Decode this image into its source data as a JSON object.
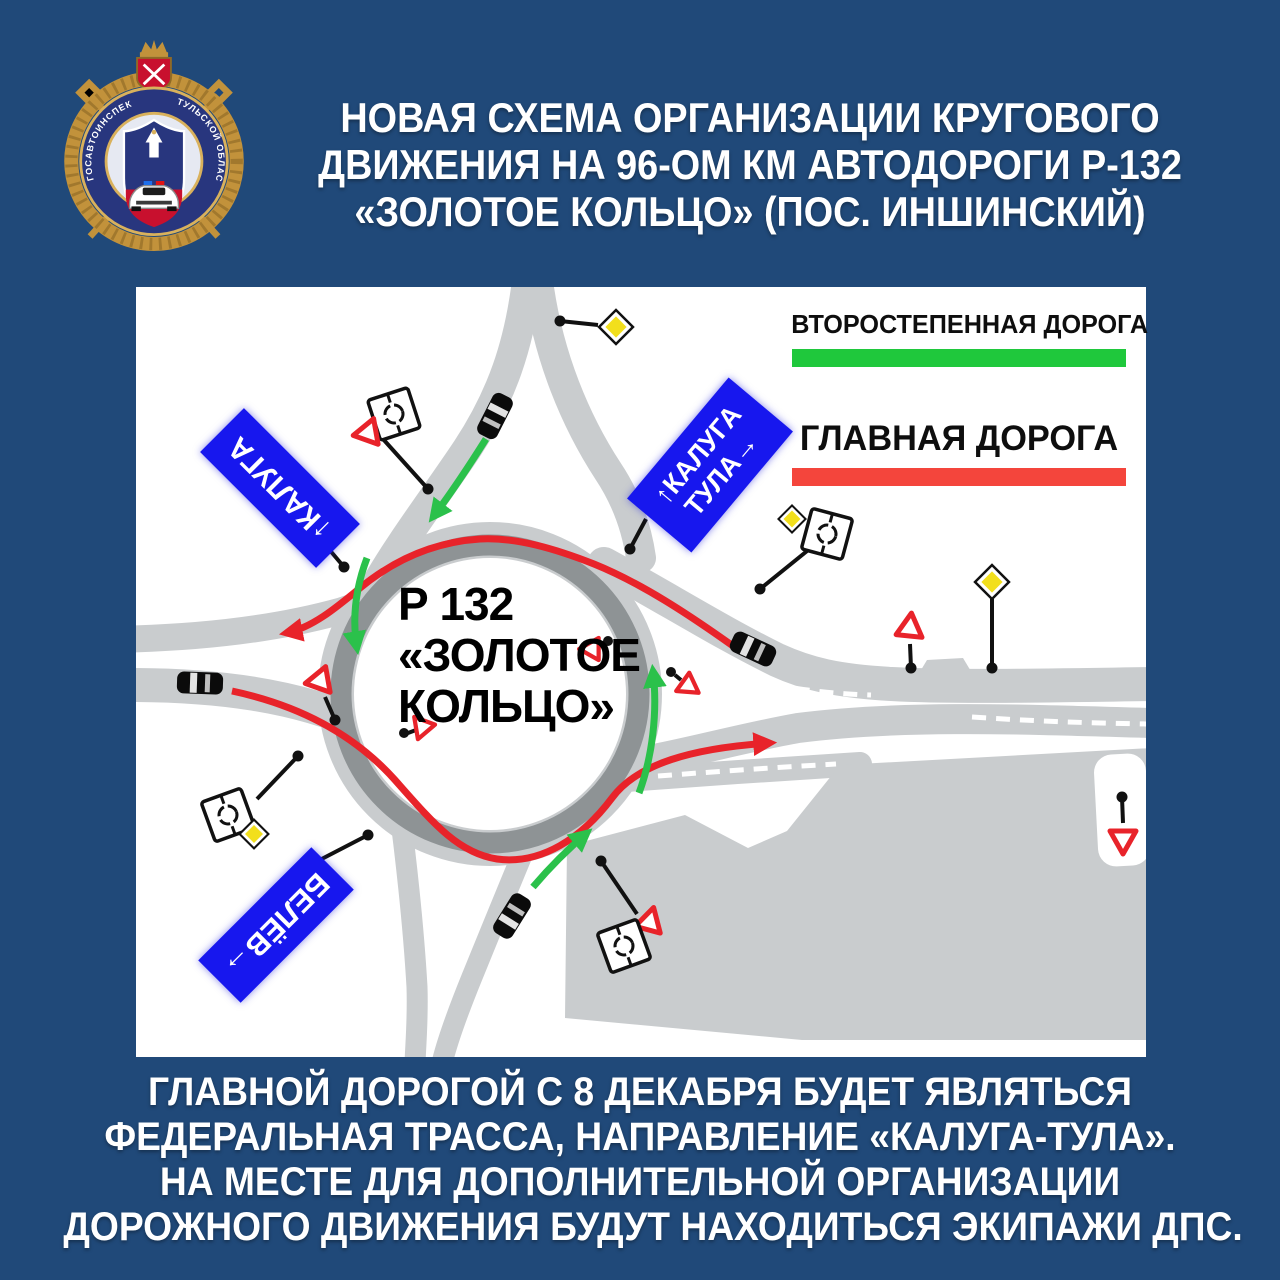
{
  "header": {
    "title_lines": [
      "НОВАЯ СХЕМА ОРГАНИЗАЦИИ КРУГОВОГО",
      "ДВИЖЕНИЯ НА 96-ОМ КМ АВТОДОРОГИ Р-132",
      "«ЗОЛОТОЕ КОЛЬЦО» (ПОС. ИНШИНСКИЙ)"
    ]
  },
  "emblem": {
    "ring_text_left": "ГОСАВТОИНСПЕКЦИЯ",
    "ring_text_right": "ТУЛЬСКОЙ ОБЛАСТИ"
  },
  "diagram": {
    "legend": {
      "secondary_label": "ВТОРОСТЕПЕННАЯ ДОРОГА",
      "secondary_color": "#1fc83c",
      "main_label": "ГЛАВНАЯ ДОРОГА",
      "main_color": "#f4453c"
    },
    "center_label": {
      "line1": "Р 132",
      "line2": "«ЗОЛОТОЕ",
      "line3": "КОЛЬЦО»"
    },
    "signs": {
      "kaluga": "↑КАЛУГА",
      "kaluga_tula_line1": "↑КАЛУГА",
      "kaluga_tula_line2": "ТУЛА→",
      "belev": "БЕЛЁВ→"
    },
    "icons": {
      "give_way_sign": "red outline triangle",
      "priority_road_sign": "yellow diamond",
      "roundabout_sign": "white plate with circular arrows",
      "car": "black car"
    },
    "colors": {
      "road": "#c9ccce",
      "ring": "#8e9395",
      "main_route": "#e8232a",
      "secondary_route": "#2bc14b",
      "direction_sign_blue": "#1717ee"
    }
  },
  "footer": {
    "lines": [
      "ГЛАВНОЙ ДОРОГОЙ С 8 ДЕКАБРЯ БУДЕТ ЯВЛЯТЬСЯ",
      "ФЕДЕРАЛЬНАЯ ТРАССА, НАПРАВЛЕНИЕ «КАЛУГА-ТУЛА».",
      "НА МЕСТЕ ДЛЯ ДОПОЛНИТЕЛЬНОЙ ОРГАНИЗАЦИИ",
      "ДОРОЖНОГО ДВИЖЕНИЯ БУДУТ НАХОДИТЬСЯ ЭКИПАЖИ ДПС."
    ]
  }
}
